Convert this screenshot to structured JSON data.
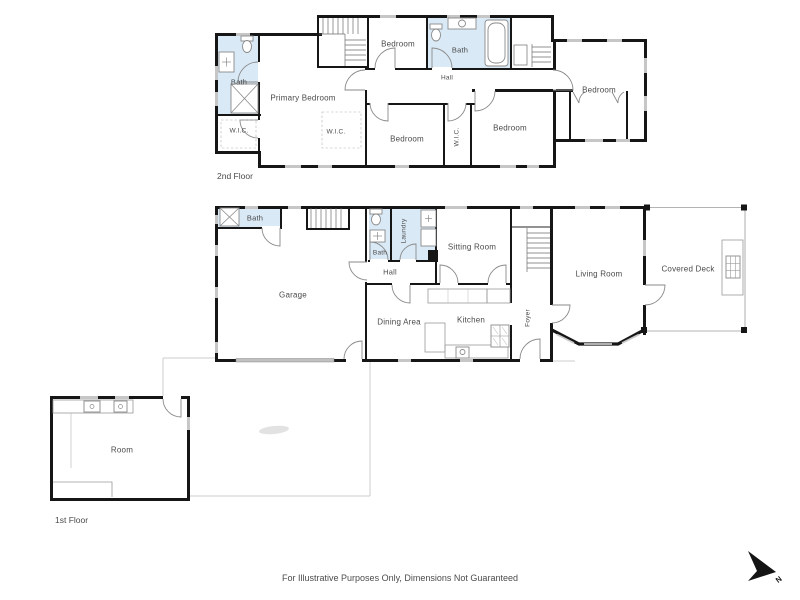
{
  "floor2": {
    "title": "2nd Floor",
    "rooms": [
      {
        "label": "Bath"
      },
      {
        "label": "Primary Bedroom"
      },
      {
        "label": "W.I.C."
      },
      {
        "label": "W.I.C."
      },
      {
        "label": "Bedroom"
      },
      {
        "label": "Bath"
      },
      {
        "label": "Hall"
      },
      {
        "label": "Bedroom"
      },
      {
        "label": "W.I.C."
      },
      {
        "label": "Bedroom"
      },
      {
        "label": "Bedroom"
      }
    ]
  },
  "floor1": {
    "title": "1st Floor",
    "rooms": [
      {
        "label": "Bath"
      },
      {
        "label": "Garage"
      },
      {
        "label": "Bath"
      },
      {
        "label": "Laundry"
      },
      {
        "label": "Hall"
      },
      {
        "label": "Sitting Room"
      },
      {
        "label": "Dining Area"
      },
      {
        "label": "Kitchen"
      },
      {
        "label": "Foyer"
      },
      {
        "label": "Living Room"
      },
      {
        "label": "Covered Deck"
      },
      {
        "label": "Room"
      }
    ]
  },
  "footer": {
    "disclaimer": "For Illustrative Purposes Only, Dimensions Not Guaranteed"
  },
  "compass": {
    "label": "N"
  },
  "colors": {
    "wall": "#161616",
    "bath_fill": "#d9e9f6",
    "window": "#c6c6c6",
    "fixture_line": "#8a8a8a",
    "label_text": "#4a4a4a",
    "patio_line": "#cdcdcd",
    "garage_door": "#bfbfbf"
  },
  "fixtures": [
    "toilet-icon",
    "vanity-sink-icon",
    "bathtub-icon",
    "shower-icon",
    "washer-dryer-icon",
    "stove-icon",
    "kitchen-sink-icon",
    "stairs-icon",
    "door-swing-icon",
    "window-icon",
    "garage-door-icon",
    "grill-icon",
    "compass-north-icon"
  ]
}
